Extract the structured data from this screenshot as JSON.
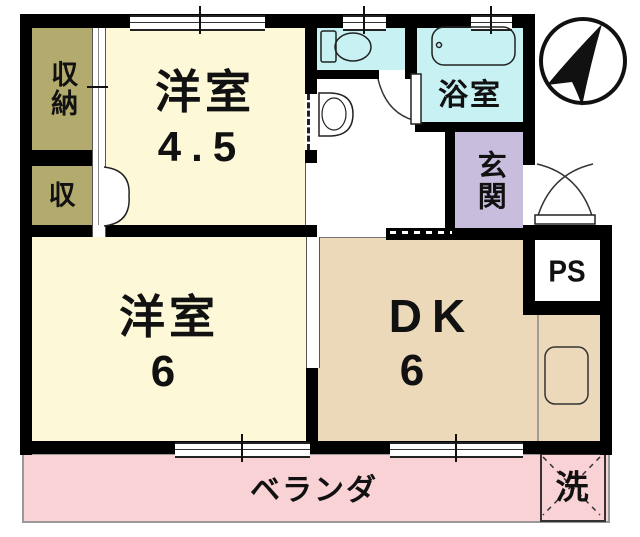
{
  "plan_title": "apartment-floor-plan",
  "colors": {
    "wall": "#000000",
    "bedroom_cream": "#fdf8d8",
    "closet_olive": "#b3aa6e",
    "wetroom_cyan": "#c7f1f3",
    "entrance_purple": "#c9bddd",
    "dk_tan": "#ecd9ba",
    "veranda_pink": "#f9d2d6"
  },
  "rooms": {
    "closet_main": {
      "label": "収納"
    },
    "closet_sub": {
      "label": "収"
    },
    "western_4_5": {
      "name": "洋室",
      "size": "4.5"
    },
    "western_6": {
      "name": "洋室",
      "size": "6"
    },
    "dining_kitchen": {
      "name": "DK",
      "size": "6"
    },
    "bathroom": {
      "label": "浴室"
    },
    "entrance": {
      "label": "玄関"
    },
    "pipe_space": {
      "label": "PS"
    },
    "veranda": {
      "label": "ベランダ"
    },
    "laundry": {
      "label": "洗"
    }
  },
  "icons": {
    "compass": "north-arrow",
    "toilet": "toilet",
    "bathtub": "bathtub",
    "washbasin": "washbasin",
    "kitchen_sink": "kitchen-sink"
  }
}
